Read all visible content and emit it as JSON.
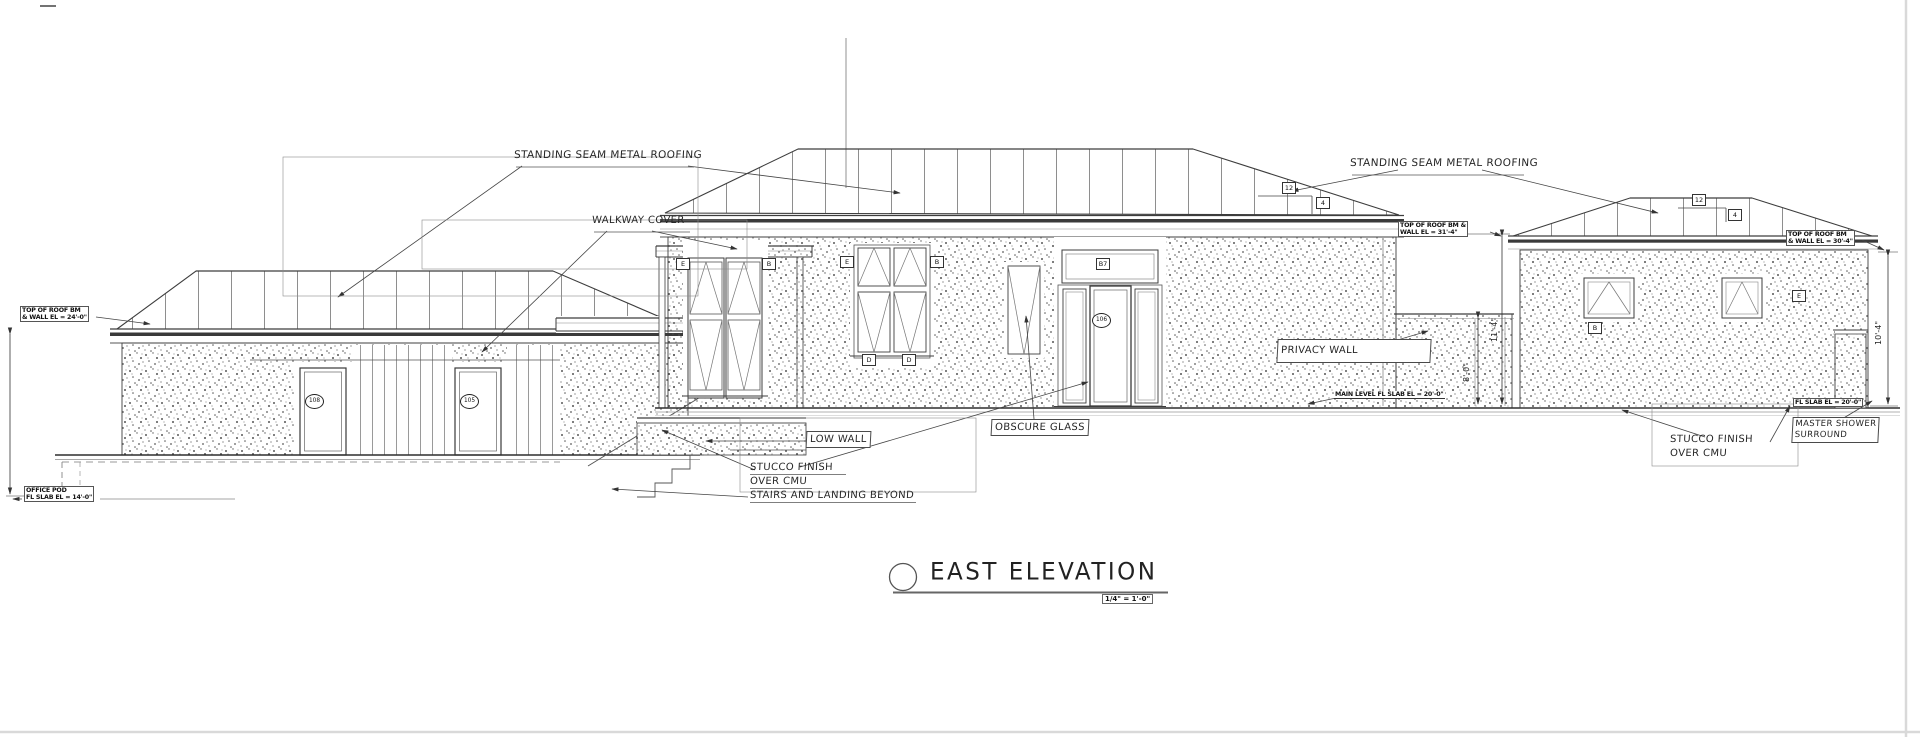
{
  "sheet": {
    "background": "#ffffff",
    "line_color": "#3d3d3d"
  },
  "title_block": {
    "title": "EAST ELEVATION",
    "scale": "1/4\" = 1'-0\""
  },
  "labels": {
    "standing_seam_left": "STANDING SEAM METAL ROOFING",
    "standing_seam_right": "STANDING SEAM METAL ROOFING",
    "walkway_cover": "WALKWAY COVER",
    "low_wall": "LOW WALL",
    "stucco_left_1": "STUCCO FINISH",
    "stucco_left_2": "OVER CMU",
    "stairs": "STAIRS AND LANDING BEYOND",
    "obscure_glass": "OBSCURE GLASS",
    "privacy_wall": "PRIVACY WALL",
    "stucco_right_1": "STUCCO FINISH",
    "stucco_right_2": "OVER CMU",
    "master_shower_1": "MASTER SHOWER",
    "master_shower_2": "SURROUND"
  },
  "callouts": {
    "left_roof_1": "TOP OF ROOF BM",
    "left_roof_2": "& WALL EL = 24'-0\"",
    "center_roof_1": "TOP OF ROOF BM &",
    "center_roof_2": "WALL EL = 31'-4\"",
    "right_roof_1": "TOP OF ROOF BM",
    "right_roof_2": "& WALL EL = 30'-4\"",
    "office_pod_1": "OFFICE POD",
    "office_pod_2": "FL SLAB EL = 14'-0\"",
    "main_level": "MAIN LEVEL FL SLAB EL = 20'-0\"",
    "right_slab": "FL SLAB EL = 20'-0\""
  },
  "dimensions": {
    "right_wall": "10'-4\"",
    "center_wall": "11'-4\"",
    "privacy_wall": "8'-0\""
  },
  "slope": {
    "run": "12",
    "rise": "4"
  },
  "tags": {
    "transom": "B7",
    "door_1": "108",
    "door_2": "105",
    "entry_door": "106",
    "win_e": "E",
    "win_b": "B",
    "win_d": "D"
  }
}
